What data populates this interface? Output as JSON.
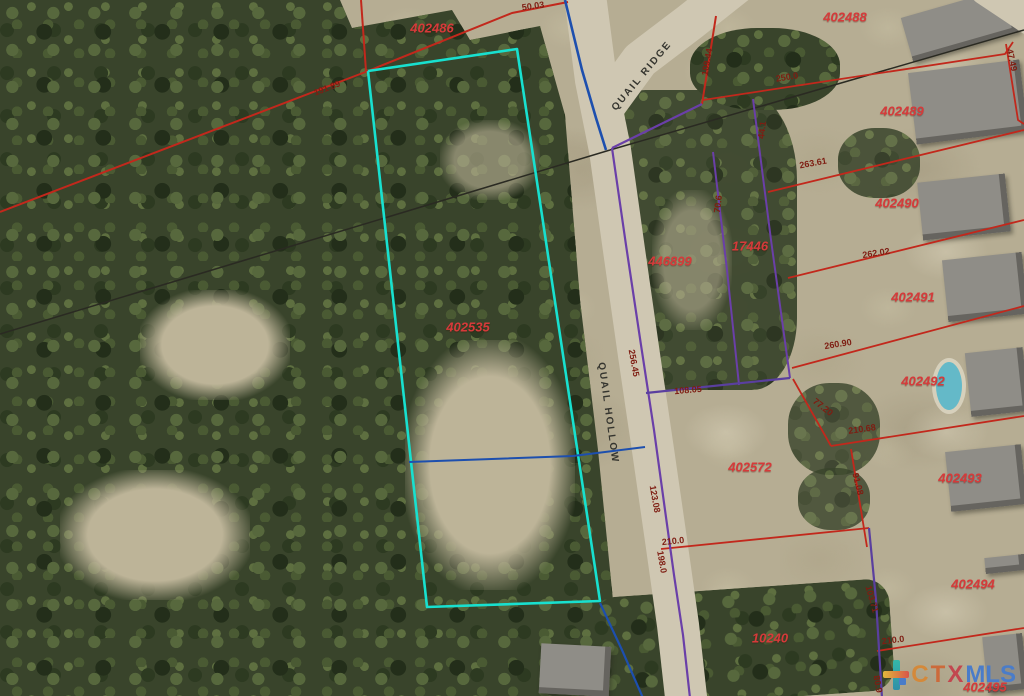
{
  "map": {
    "streets": [
      {
        "name": "QUAIL RIDGE",
        "x": 642,
        "y": 76,
        "rot": -50
      },
      {
        "name": "QUAIL HOLLOW",
        "x": 608,
        "y": 413,
        "rot": 82
      }
    ],
    "parcels": [
      {
        "text": "402486",
        "x": 432,
        "y": 28
      },
      {
        "text": "402488",
        "x": 845,
        "y": 17
      },
      {
        "text": "402489",
        "x": 902,
        "y": 111
      },
      {
        "text": "402490",
        "x": 897,
        "y": 203
      },
      {
        "text": "402491",
        "x": 913,
        "y": 297
      },
      {
        "text": "402492",
        "x": 923,
        "y": 381
      },
      {
        "text": "402493",
        "x": 960,
        "y": 478
      },
      {
        "text": "402494",
        "x": 973,
        "y": 584
      },
      {
        "text": "402495",
        "x": 985,
        "y": 687
      },
      {
        "text": "446899",
        "x": 670,
        "y": 261
      },
      {
        "text": "17446",
        "x": 750,
        "y": 246
      },
      {
        "text": "402572",
        "x": 750,
        "y": 467
      },
      {
        "text": "402535",
        "x": 468,
        "y": 327
      },
      {
        "text": "10240",
        "x": 770,
        "y": 638
      }
    ],
    "dimensions": [
      {
        "text": "50.03",
        "x": 533,
        "y": 6,
        "rot": -8
      },
      {
        "text": "191.89",
        "x": 327,
        "y": 88,
        "rot": -21
      },
      {
        "text": "109.44",
        "x": 707,
        "y": 62,
        "rot": -80
      },
      {
        "text": "250.0",
        "x": 787,
        "y": 77,
        "rot": -9
      },
      {
        "text": "47.49",
        "x": 1012,
        "y": 60,
        "rot": 78
      },
      {
        "text": "263.61",
        "x": 813,
        "y": 163,
        "rot": -10
      },
      {
        "text": "70.6",
        "x": 718,
        "y": 204,
        "rot": -83
      },
      {
        "text": "44.1",
        "x": 762,
        "y": 130,
        "rot": -83
      },
      {
        "text": "262.02",
        "x": 876,
        "y": 253,
        "rot": -9
      },
      {
        "text": "260.90",
        "x": 838,
        "y": 344,
        "rot": -9
      },
      {
        "text": "256.45",
        "x": 634,
        "y": 363,
        "rot": 80
      },
      {
        "text": "108.05",
        "x": 688,
        "y": 390,
        "rot": -5
      },
      {
        "text": "77.20",
        "x": 823,
        "y": 407,
        "rot": 38
      },
      {
        "text": "210.68",
        "x": 862,
        "y": 429,
        "rot": -8
      },
      {
        "text": "91.08",
        "x": 858,
        "y": 484,
        "rot": 76
      },
      {
        "text": "123.08",
        "x": 655,
        "y": 499,
        "rot": 80
      },
      {
        "text": "210.0",
        "x": 673,
        "y": 541,
        "rot": -6
      },
      {
        "text": "198.0",
        "x": 662,
        "y": 562,
        "rot": 80
      },
      {
        "text": "103.71",
        "x": 872,
        "y": 599,
        "rot": 74
      },
      {
        "text": "210.0",
        "x": 893,
        "y": 640,
        "rot": -7
      },
      {
        "text": "80.9",
        "x": 878,
        "y": 684,
        "rot": 80
      }
    ],
    "line_colors": {
      "highlight_parcel": "#18e0cf",
      "plat_red": "#c2281c",
      "plat_purple": "#6a3fa8",
      "plat_blue": "#1d4fae",
      "utility_black": "#2a2a22",
      "road_surface": "#cfc7b2"
    },
    "lines": [
      {
        "name": "road-surface-quail-hollow",
        "color": "#cfc7b2",
        "width": 42,
        "points": [
          [
            583,
            -20
          ],
          [
            596,
            80
          ],
          [
            610,
            150
          ],
          [
            624,
            250
          ],
          [
            639,
            355
          ],
          [
            653,
            450
          ],
          [
            666,
            540
          ],
          [
            678,
            625
          ],
          [
            687,
            706
          ]
        ]
      },
      {
        "name": "road-surface-quail-ridge",
        "color": "#cfc7b2",
        "width": 38,
        "points": [
          [
            602,
            112
          ],
          [
            640,
            60
          ],
          [
            690,
            22
          ],
          [
            738,
            -16
          ]
        ]
      },
      {
        "name": "road-surface-top-right-corner",
        "color": "#cfc7b2",
        "width": 30,
        "points": [
          [
            985,
            -10
          ],
          [
            1030,
            20
          ]
        ]
      },
      {
        "name": "utility-line-west",
        "color": "#2a2a22",
        "width": 1.5,
        "points": [
          [
            0,
            334
          ],
          [
            610,
            150
          ]
        ]
      },
      {
        "name": "utility-line-east",
        "color": "#2a2a22",
        "width": 1.5,
        "points": [
          [
            610,
            150
          ],
          [
            1024,
            30
          ]
        ]
      },
      {
        "name": "boundary-red-topleft-diagonal",
        "color": "#c2281c",
        "width": 2,
        "points": [
          [
            0,
            212
          ],
          [
            368,
            71
          ],
          [
            512,
            13
          ],
          [
            568,
            2
          ]
        ]
      },
      {
        "name": "boundary-red-top-vertical",
        "color": "#c2281c",
        "width": 2,
        "points": [
          [
            361,
            0
          ],
          [
            366,
            71
          ]
        ]
      },
      {
        "name": "boundary-red-109",
        "color": "#c2281c",
        "width": 2,
        "points": [
          [
            716,
            16
          ],
          [
            702,
            104
          ]
        ]
      },
      {
        "name": "boundary-red-250",
        "color": "#c2281c",
        "width": 1.8,
        "points": [
          [
            703,
            100
          ],
          [
            1005,
            54
          ],
          [
            1013,
            42
          ]
        ]
      },
      {
        "name": "boundary-red-4749",
        "color": "#c2281c",
        "width": 1.8,
        "points": [
          [
            1006,
            44
          ],
          [
            1018,
            120
          ],
          [
            1024,
            124
          ]
        ]
      },
      {
        "name": "boundary-red-26361",
        "color": "#c2281c",
        "width": 1.8,
        "points": [
          [
            768,
            192
          ],
          [
            1024,
            130
          ]
        ]
      },
      {
        "name": "boundary-red-26202",
        "color": "#c2281c",
        "width": 1.8,
        "points": [
          [
            788,
            278
          ],
          [
            1024,
            220
          ]
        ]
      },
      {
        "name": "boundary-red-26090",
        "color": "#c2281c",
        "width": 1.8,
        "points": [
          [
            792,
            368
          ],
          [
            1024,
            306
          ]
        ]
      },
      {
        "name": "boundary-red-7720",
        "color": "#c2281c",
        "width": 1.8,
        "points": [
          [
            793,
            379
          ],
          [
            831,
            446
          ]
        ]
      },
      {
        "name": "boundary-red-21068",
        "color": "#c2281c",
        "width": 1.8,
        "points": [
          [
            831,
            446
          ],
          [
            1024,
            416
          ]
        ]
      },
      {
        "name": "boundary-red-9108",
        "color": "#c2281c",
        "width": 1.8,
        "points": [
          [
            851,
            449
          ],
          [
            867,
            547
          ]
        ]
      },
      {
        "name": "boundary-red-2100-south-402572",
        "color": "#c2281c",
        "width": 1.8,
        "points": [
          [
            661,
            549
          ],
          [
            869,
            528
          ]
        ]
      },
      {
        "name": "boundary-red-2100-bottom",
        "color": "#c2281c",
        "width": 1.8,
        "points": [
          [
            877,
            651
          ],
          [
            1024,
            628
          ]
        ]
      },
      {
        "name": "boundary-purple-road-east",
        "color": "#6a3fa8",
        "width": 2.2,
        "points": [
          [
            612,
            148
          ],
          [
            626,
            245
          ],
          [
            641,
            345
          ],
          [
            654,
            430
          ],
          [
            665,
            510
          ],
          [
            674,
            575
          ],
          [
            683,
            635
          ],
          [
            690,
            698
          ]
        ]
      },
      {
        "name": "boundary-purple-north",
        "color": "#6a3fa8",
        "width": 2.2,
        "points": [
          [
            612,
            148
          ],
          [
            702,
            104
          ]
        ]
      },
      {
        "name": "boundary-purple-inner-1",
        "color": "#6a3fa8",
        "width": 2,
        "points": [
          [
            713,
            152
          ],
          [
            727,
            270
          ],
          [
            739,
            385
          ]
        ]
      },
      {
        "name": "boundary-purple-inner-2",
        "color": "#6a3fa8",
        "width": 2,
        "points": [
          [
            753,
            99
          ],
          [
            771,
            240
          ],
          [
            790,
            378
          ]
        ]
      },
      {
        "name": "boundary-purple-10805",
        "color": "#5a3f9f",
        "width": 2.2,
        "points": [
          [
            646,
            393
          ],
          [
            790,
            378
          ]
        ]
      },
      {
        "name": "boundary-purple-west-402494",
        "color": "#5a3f9f",
        "width": 2.2,
        "points": [
          [
            869,
            528
          ],
          [
            876,
            600
          ],
          [
            882,
            698
          ]
        ]
      },
      {
        "name": "boundary-cyan-highlight-parcel",
        "color": "#18e0cf",
        "width": 2.6,
        "points": [
          [
            368,
            71
          ],
          [
            517,
            49
          ],
          [
            600,
            601
          ],
          [
            427,
            607
          ],
          [
            368,
            71
          ]
        ]
      },
      {
        "name": "boundary-blue-road-top",
        "color": "#1d4fae",
        "width": 2.6,
        "points": [
          [
            565,
            0
          ],
          [
            582,
            70
          ],
          [
            596,
            118
          ],
          [
            606,
            150
          ]
        ]
      },
      {
        "name": "boundary-blue-cross",
        "color": "#1d4fae",
        "width": 2,
        "points": [
          [
            409,
            462
          ],
          [
            573,
            456
          ],
          [
            645,
            447
          ]
        ]
      },
      {
        "name": "boundary-blue-bottom",
        "color": "#1d4fae",
        "width": 2.2,
        "points": [
          [
            600,
            603
          ],
          [
            622,
            650
          ],
          [
            643,
            698
          ]
        ]
      }
    ],
    "houses": [
      {
        "x": 905,
        "y": 2,
        "w": 110,
        "h": 46,
        "rot": -16
      },
      {
        "x": 912,
        "y": 66,
        "w": 112,
        "h": 72,
        "rot": -7
      },
      {
        "x": 920,
        "y": 178,
        "w": 88,
        "h": 58,
        "rot": -6
      },
      {
        "x": 945,
        "y": 256,
        "w": 80,
        "h": 62,
        "rot": -6
      },
      {
        "x": 968,
        "y": 350,
        "w": 58,
        "h": 64,
        "rot": -6
      },
      {
        "x": 948,
        "y": 448,
        "w": 76,
        "h": 60,
        "rot": -6
      },
      {
        "x": 985,
        "y": 556,
        "w": 40,
        "h": 16,
        "rot": -6
      },
      {
        "x": 985,
        "y": 635,
        "w": 40,
        "h": 56,
        "rot": -6
      },
      {
        "x": 540,
        "y": 645,
        "w": 70,
        "h": 50,
        "rot": 3
      }
    ],
    "pool": {
      "x": 936,
      "y": 362,
      "w": 26,
      "h": 48
    }
  },
  "watermark": {
    "c": "C",
    "t": "T",
    "x": "X",
    "mls": "MLS",
    "colors": {
      "c": "#d4893a",
      "t": "#cc6a3a",
      "x": "#c2474f",
      "mls": "#4a7cc9"
    }
  }
}
